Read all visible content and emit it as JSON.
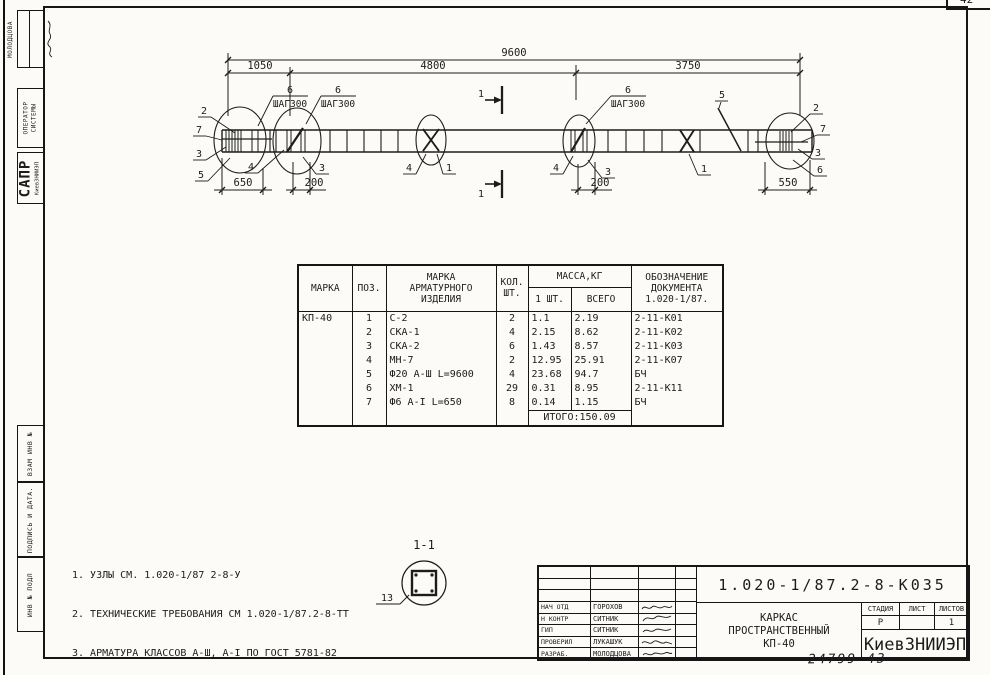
{
  "colors": {
    "ink": "#1c1c1c",
    "paper": "#fcfbf7"
  },
  "page": {
    "number": "42",
    "footer_code": "24799  43"
  },
  "stamp_left": {
    "author": "МОЛОДЦОВА",
    "operator": "ОПЕРАТОР\nСИСТЕМЫ",
    "sapr": "САПР",
    "sapr_org": "КиевЗНИИЭП",
    "vzam": "ВЗАМ ИНВ №",
    "podpis": "ПОДПИСЬ И ДАТА.",
    "inv": "ИНВ № ПОДЛ"
  },
  "drawing": {
    "dim_total": "9600",
    "dim_seg1": "1050",
    "dim_seg2": "4800",
    "dim_seg3": "3750",
    "dim_left_end": "650",
    "dim_step_left": "200",
    "dim_step_right": "200",
    "dim_right_end": "550",
    "step_pos": "6",
    "step_text": "ШАГ300",
    "section_mark": "1",
    "pos1": "1",
    "pos2": "2",
    "pos3": "3",
    "pos4": "4",
    "pos5": "5",
    "pos6": "6",
    "pos7": "7",
    "section_title": "1-1",
    "section_pos": "13"
  },
  "table": {
    "h_marka": "МАРКА",
    "h_poz": "ПОЗ.",
    "h_item": "МАРКА\nАРМАТУРНОГО\nИЗДЕЛИЯ",
    "h_qty": "КОЛ.\nШТ.",
    "h_mass": "МАССА,КГ",
    "h_one": "1 ШТ.",
    "h_total": "ВСЕГО",
    "h_doc": "ОБОЗНАЧЕНИЕ\nДОКУМЕНТА\n1.020-1/87.",
    "marka_value": "КП-40",
    "rows": [
      {
        "poz": "1",
        "item": "С-2",
        "qty": "2",
        "one": "1.1",
        "total": "2.19",
        "doc": "2-11-К01"
      },
      {
        "poz": "2",
        "item": "СКА-1",
        "qty": "4",
        "one": "2.15",
        "total": "8.62",
        "doc": "2-11-К02"
      },
      {
        "poz": "3",
        "item": "СКА-2",
        "qty": "6",
        "one": "1.43",
        "total": "8.57",
        "doc": "2-11-К03"
      },
      {
        "poz": "4",
        "item": "МН-7",
        "qty": "2",
        "one": "12.95",
        "total": "25.91",
        "doc": "2-11-К07"
      },
      {
        "poz": "5",
        "item": "Ф20 А-Ш L=9600",
        "qty": "4",
        "one": "23.68",
        "total": "94.7",
        "doc": "БЧ"
      },
      {
        "poz": "6",
        "item": "ХМ-1",
        "qty": "29",
        "one": "0.31",
        "total": "8.95",
        "doc": "2-11-К11"
      },
      {
        "poz": "7",
        "item": "Ф6 А-I L=650",
        "qty": "8",
        "one": "0.14",
        "total": "1.15",
        "doc": "БЧ"
      }
    ],
    "itogo": "ИТОГО:150.09"
  },
  "notes": [
    "1. УЗЛЫ СМ. 1.020-1/87 2-8-У",
    "2. ТЕХНИЧЕСКИЕ ТРЕБОВАНИЯ СМ 1.020-1/87.2-8-ТТ",
    "3. АРМАТУРА КЛАССОВ А-Ш, А-I ПО ГОСТ 5781-82"
  ],
  "titleblock": {
    "doc_number": "1.020-1/87.2-8-К035",
    "approvals": [
      {
        "role": "НАЧ ОТД",
        "name": "ГОРОХОВ"
      },
      {
        "role": "Н КОНТР",
        "name": "СИТНИК"
      },
      {
        "role": "ГИП",
        "name": "СИТНИК"
      },
      {
        "role": "ПРОВЕРИЛ",
        "name": "ЛУКАШУК"
      },
      {
        "role": "РАЗРАБ.",
        "name": "МОЛОДЦОВА"
      }
    ],
    "title_line1": "КАРКАС",
    "title_line2": "ПРОСТРАНСТВЕННЫЙ",
    "title_line3": "КП-40",
    "stadia_label": "СТАДИЯ",
    "list_label": "ЛИСТ",
    "listov_label": "ЛИСТОВ",
    "stadia_value": "Р",
    "list_value": "",
    "listov_value": "1",
    "org": "КиевЗНИИЭП"
  }
}
